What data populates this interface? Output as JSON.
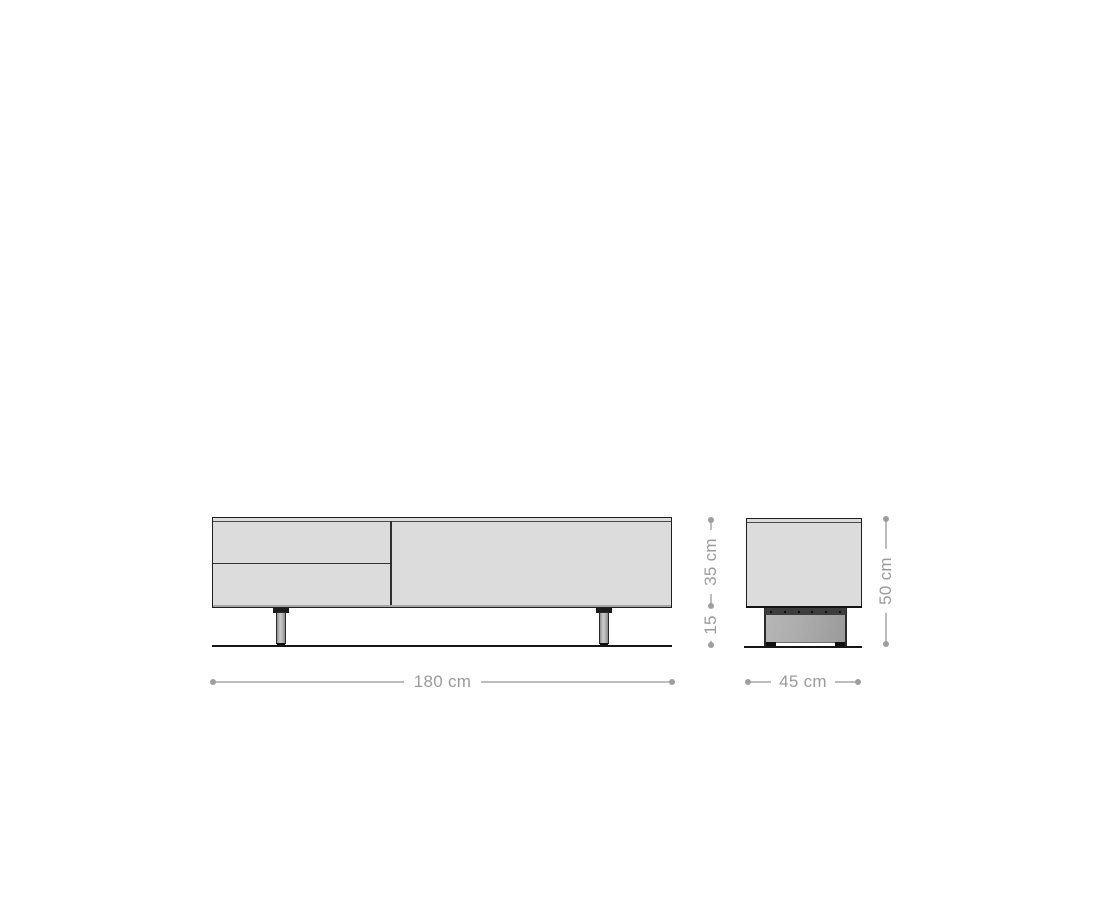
{
  "diagram": {
    "type": "furniture-dimension-drawing",
    "subject": "tv-lowboard",
    "dimensions": {
      "width": "180 cm",
      "depth": "45 cm",
      "body_height": "35 cm",
      "leg_height": "15",
      "total_height": "50 cm"
    },
    "colors": {
      "background": "#ffffff",
      "outline": "#1f1f1f",
      "panel_fill": "#dcdcdc",
      "base_fill": "#a8a8a8",
      "dimension_line": "#bdbdbd",
      "dimension_text": "#9b9b9b"
    }
  }
}
